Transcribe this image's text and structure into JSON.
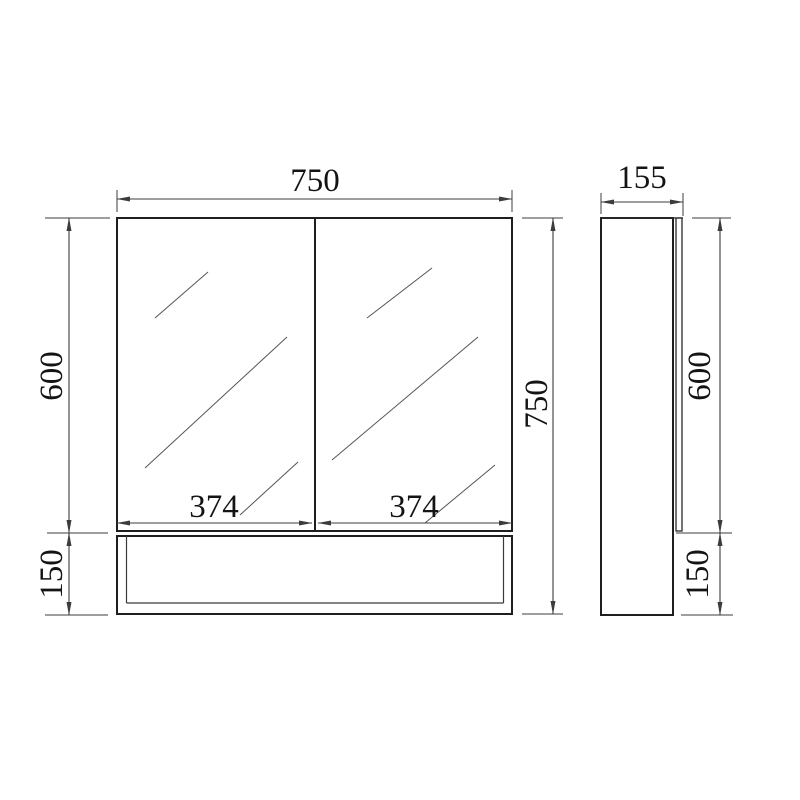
{
  "drawing": {
    "type": "technical-dimension-diagram",
    "subject": "mirror cabinet with open bottom shelf",
    "front_view": {
      "overall_width": "750",
      "overall_height": "750",
      "mirror_door_height": "600",
      "shelf_height": "150",
      "left_door_width": "374",
      "right_door_width": "374"
    },
    "side_view": {
      "depth": "155",
      "mirror_door_height": "600",
      "shelf_height": "150"
    },
    "colors": {
      "background": "#ffffff",
      "outline": "#1f1f1f",
      "dimension_line": "#3c3c3c",
      "glass_mark": "#555555",
      "text": "#141414"
    }
  }
}
